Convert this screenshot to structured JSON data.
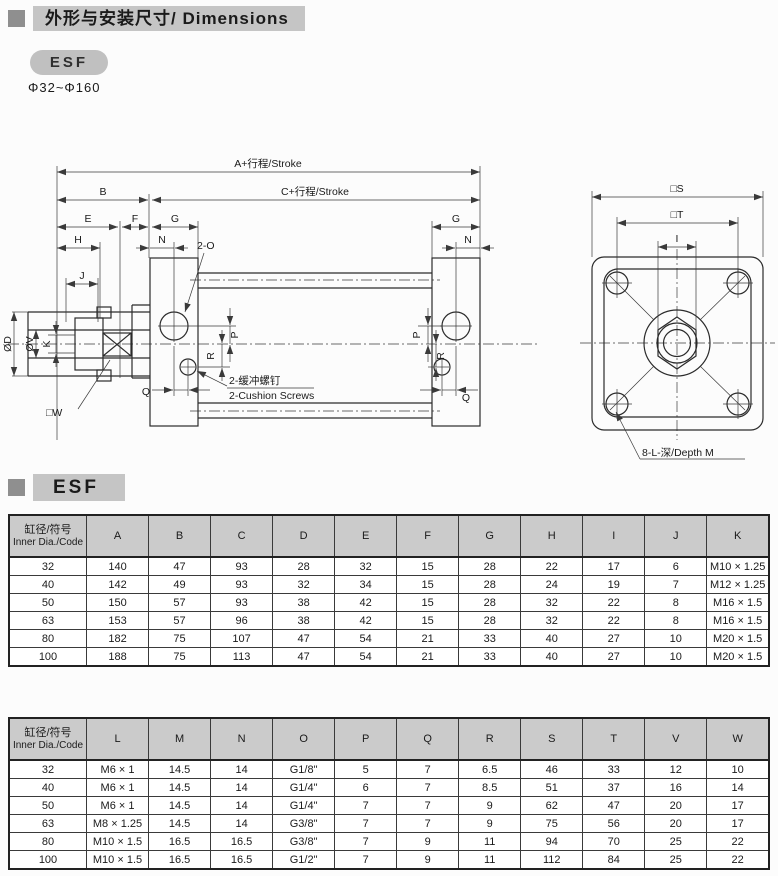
{
  "colors": {
    "bullet": "#8f8f8f",
    "bar_bg": "#c5c5c5",
    "pill_bg": "#c0c0c0",
    "th_bg": "#cbcbcb",
    "line": "#2b2b2b",
    "ink": "#1a1a1a"
  },
  "header": {
    "title": "外形与安装尺寸/ Dimensions",
    "model": "ESF",
    "bore_range": "Φ32~Φ160"
  },
  "section": {
    "label": "ESF"
  },
  "drawing": {
    "labels": {
      "a_stroke": "A+行程/Stroke",
      "c_stroke": "C+行程/Stroke",
      "b": "B",
      "e": "E",
      "f": "F",
      "g": "G",
      "h": "H",
      "n": "N",
      "j": "J",
      "ports": "2-O",
      "od": "ØD",
      "ov": "ØV",
      "k": "K",
      "w": "□W",
      "p": "P",
      "r": "R",
      "q": "Q",
      "cushion_cn": "2-缓冲螺钉",
      "cushion_en": "2-Cushion Screws",
      "s": "□S",
      "t": "□T",
      "i": "I",
      "depth": "8-L-深/Depth M"
    }
  },
  "table1": {
    "first_col_header": {
      "cn": "缸径/符号",
      "en": "Inner Dia./Code"
    },
    "columns": [
      "A",
      "B",
      "C",
      "D",
      "E",
      "F",
      "G",
      "H",
      "I",
      "J",
      "K"
    ],
    "rows": [
      {
        "code": "32",
        "values": [
          "140",
          "47",
          "93",
          "28",
          "32",
          "15",
          "28",
          "22",
          "17",
          "6",
          "M10 × 1.25"
        ]
      },
      {
        "code": "40",
        "values": [
          "142",
          "49",
          "93",
          "32",
          "34",
          "15",
          "28",
          "24",
          "19",
          "7",
          "M12 × 1.25"
        ]
      },
      {
        "code": "50",
        "values": [
          "150",
          "57",
          "93",
          "38",
          "42",
          "15",
          "28",
          "32",
          "22",
          "8",
          "M16 × 1.5"
        ]
      },
      {
        "code": "63",
        "values": [
          "153",
          "57",
          "96",
          "38",
          "42",
          "15",
          "28",
          "32",
          "22",
          "8",
          "M16 × 1.5"
        ]
      },
      {
        "code": "80",
        "values": [
          "182",
          "75",
          "107",
          "47",
          "54",
          "21",
          "33",
          "40",
          "27",
          "10",
          "M20 × 1.5"
        ]
      },
      {
        "code": "100",
        "values": [
          "188",
          "75",
          "113",
          "47",
          "54",
          "21",
          "33",
          "40",
          "27",
          "10",
          "M20 × 1.5"
        ]
      }
    ]
  },
  "table2": {
    "first_col_header": {
      "cn": "缸径/符号",
      "en": "Inner Dia./Code"
    },
    "columns": [
      "L",
      "M",
      "N",
      "O",
      "P",
      "Q",
      "R",
      "S",
      "T",
      "V",
      "W"
    ],
    "rows": [
      {
        "code": "32",
        "values": [
          "M6 × 1",
          "14.5",
          "14",
          "G1/8\"",
          "5",
          "7",
          "6.5",
          "46",
          "33",
          "12",
          "10"
        ]
      },
      {
        "code": "40",
        "values": [
          "M6 × 1",
          "14.5",
          "14",
          "G1/4\"",
          "6",
          "7",
          "8.5",
          "51",
          "37",
          "16",
          "14"
        ]
      },
      {
        "code": "50",
        "values": [
          "M6 × 1",
          "14.5",
          "14",
          "G1/4\"",
          "7",
          "7",
          "9",
          "62",
          "47",
          "20",
          "17"
        ]
      },
      {
        "code": "63",
        "values": [
          "M8 × 1.25",
          "14.5",
          "14",
          "G3/8\"",
          "7",
          "7",
          "9",
          "75",
          "56",
          "20",
          "17"
        ]
      },
      {
        "code": "80",
        "values": [
          "M10 × 1.5",
          "16.5",
          "16.5",
          "G3/8\"",
          "7",
          "9",
          "11",
          "94",
          "70",
          "25",
          "22"
        ]
      },
      {
        "code": "100",
        "values": [
          "M10 × 1.5",
          "16.5",
          "16.5",
          "G1/2\"",
          "7",
          "9",
          "11",
          "112",
          "84",
          "25",
          "22"
        ]
      }
    ]
  }
}
